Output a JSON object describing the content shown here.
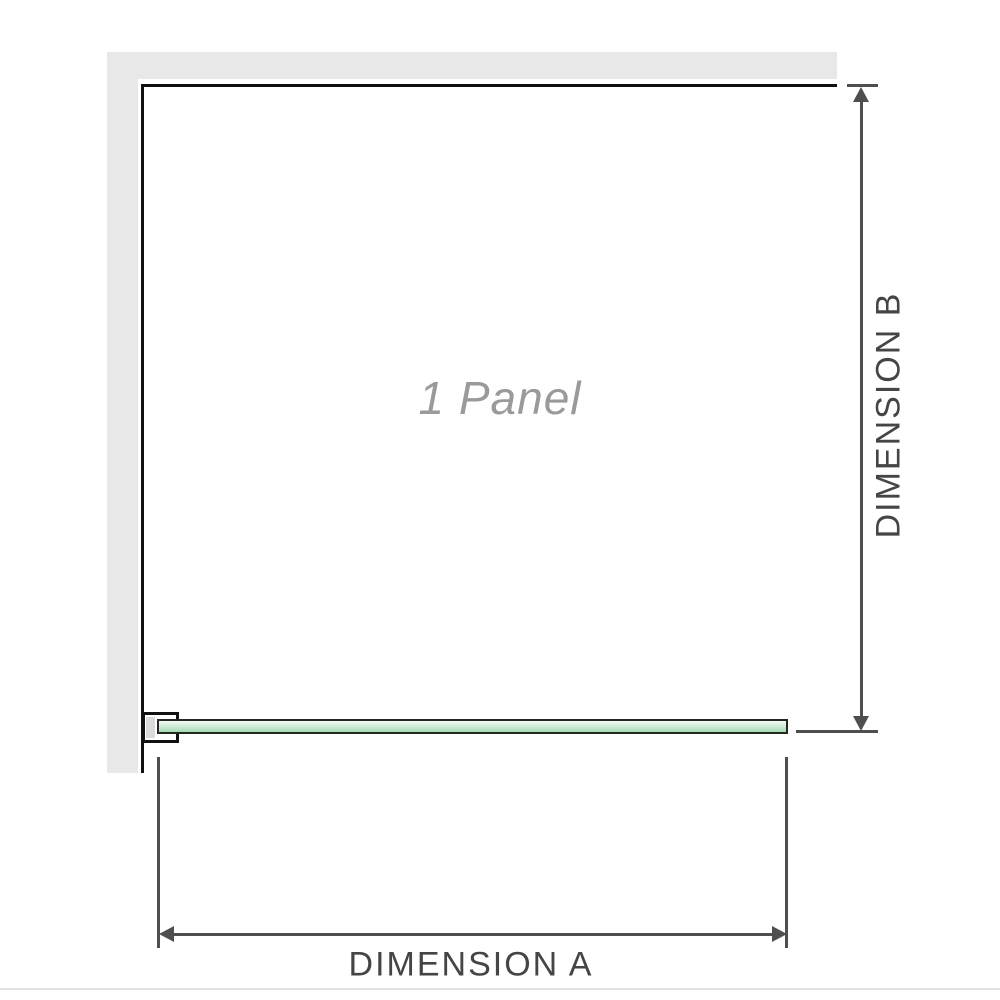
{
  "diagram": {
    "panel_label": "1 Panel",
    "dimension_a_label": "DIMENSION A",
    "dimension_b_label": "DIMENSION B"
  },
  "colors": {
    "wall": "#e8e8e8",
    "outline": "#111111",
    "dimension": "#4f4f4f",
    "glass_border": "#222a20",
    "glass_green": "#a5dab4",
    "clamp_fill": "#dadada",
    "label_gray": "#9a9a9a",
    "text": "#454545",
    "baseline": "#e0e0e0"
  }
}
